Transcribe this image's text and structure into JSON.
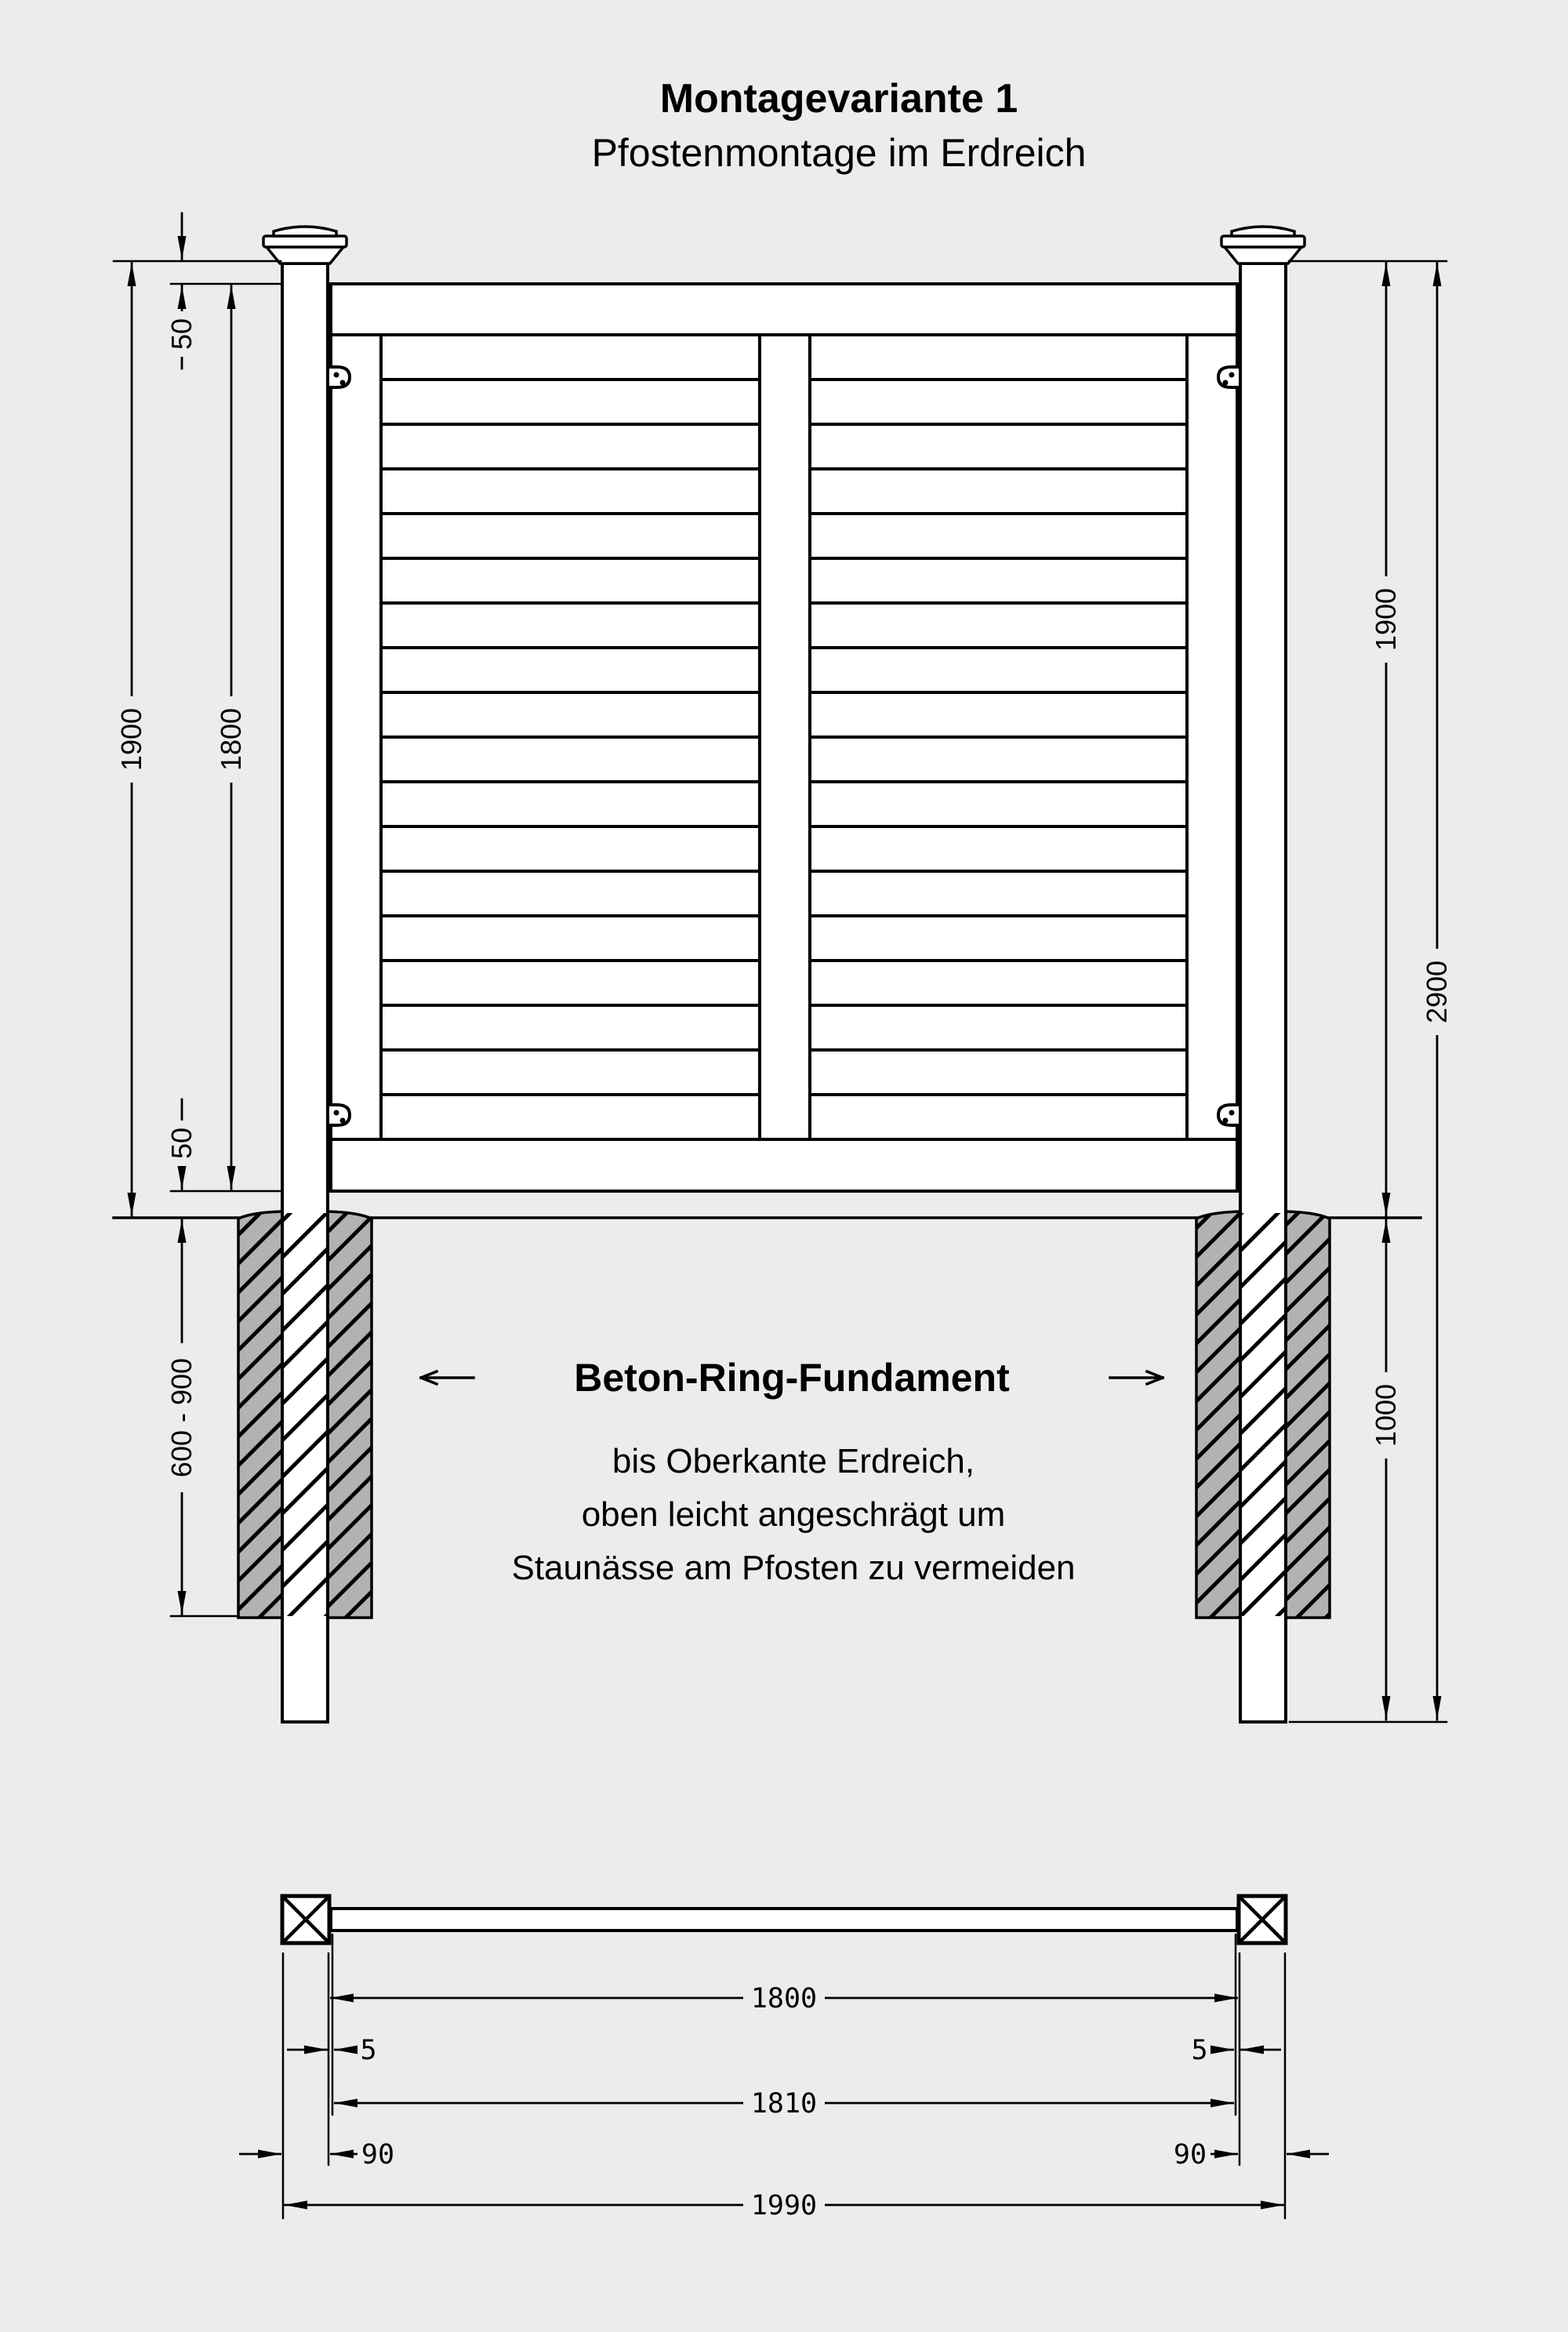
{
  "title": {
    "line1": "Montagevariante 1",
    "line2": "Pfostenmontage im Erdreich"
  },
  "front_view": {
    "dimensions": {
      "post_height_left": "1900",
      "panel_height": "1800",
      "cap_offset_top": "50",
      "ground_clearance": "50",
      "foundation_depth": "600 - 900",
      "post_height_right": "1900",
      "total_height": "2900",
      "buried_length": "1000"
    },
    "foundation_note": {
      "heading": "Beton-Ring-Fundament",
      "line1": "bis Oberkante Erdreich,",
      "line2": "oben leicht angeschrägt um",
      "line3": "Staunässe am Pfosten zu vermeiden"
    }
  },
  "plan_view": {
    "dimensions": {
      "clear_span": "1800",
      "overlap_left": "5",
      "overlap_right": "5",
      "panel_length": "1810",
      "post_width_left": "90",
      "post_width_right": "90",
      "overall_width": "1990"
    }
  },
  "colors": {
    "background": "#ececec",
    "line": "#000000",
    "foundation": "#b2b2b2"
  }
}
